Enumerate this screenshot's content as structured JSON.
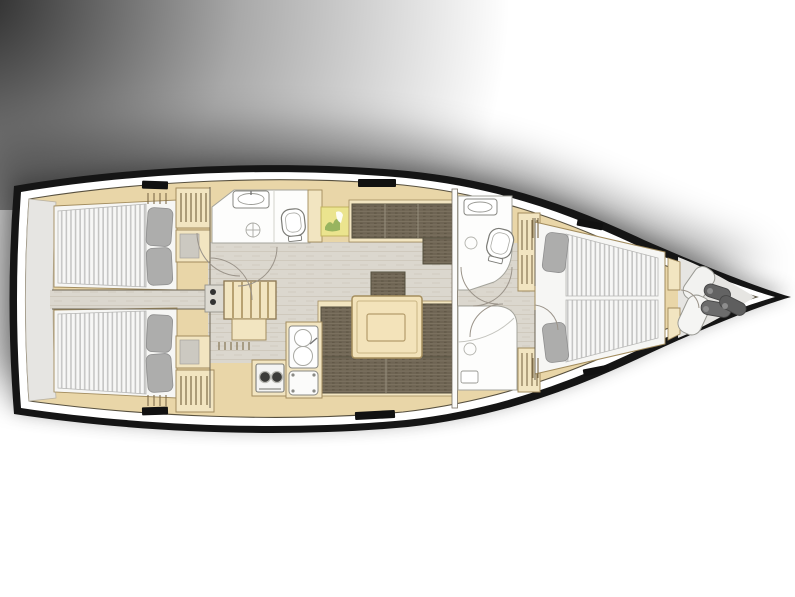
{
  "diagram": {
    "label": "Sailing yacht interior deck layout plan, bow pointing right",
    "areas": {
      "transom": "transom-garage",
      "aft_cabin_upper": "aft-double-cabin-upper",
      "aft_cabin_lower": "aft-double-cabin-lower",
      "aft_head": "aft-bathroom",
      "companionway": "companionway-steps",
      "nav": "chart-table",
      "saloon": "saloon-dinette",
      "galley": "galley",
      "fwd_head": "forward-bathroom",
      "fwd_shower": "forward-shower",
      "fwd_cabin": "forward-double-cabin",
      "bow_locker": "bow-sail-locker"
    },
    "fixtures": [
      "bed",
      "pillow",
      "wardrobe-hangers",
      "washbasin",
      "toilet",
      "shower-drain",
      "stove",
      "double-sink",
      "fridge",
      "dinette-table",
      "sofa",
      "chart-map",
      "fender",
      "sail-bag",
      "deck-hatch",
      "door-swing"
    ]
  },
  "colors": {
    "hull-outline": "#151515",
    "deck-band": "#ffffff",
    "interior-wood": "#e9d6a8",
    "furniture-wood": "#f2e5c1",
    "wood-line": "#a28c5e",
    "wood-dark-line": "#6b6352",
    "floor": "#dbd7ce",
    "floor-line": "#cfc9bd",
    "white-room": "#fdfdfc",
    "room-line": "#a3a39b",
    "mattress": "#f7f7f6",
    "mattress-stripe": "#c3c3c2",
    "bed-base": "#f6f6f4",
    "pillow": "#adadac",
    "pillow-line": "#8f8f8f",
    "sofa": "#6e6453",
    "sofa-line": "#5c5343",
    "sofa-highlight": "#7d7361",
    "table-wood": "#f3e3ba",
    "chart-yellow": "#ebe48e",
    "chart-green": "#8fae5a",
    "gray-zone": "#e6e5e2",
    "hatch-black": "#111111",
    "arc-line": "#9b948a",
    "fixture-line": "#888883",
    "fender-gray": "#636363",
    "shadow": "#1c1c1c"
  }
}
